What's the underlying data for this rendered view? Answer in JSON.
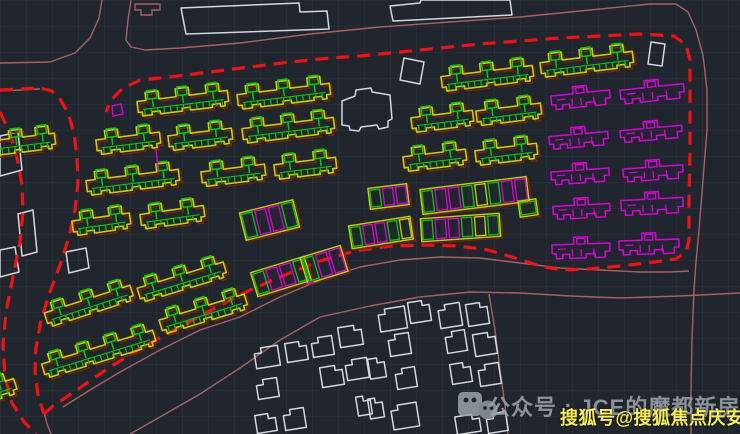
{
  "app": {
    "description": "CAD site plan viewport, dark theme",
    "canvas": {
      "width": 740,
      "height": 434,
      "background": "#20262e",
      "grid_size": 26
    }
  },
  "colors": {
    "yellow": "#c9cf00",
    "green": "#0ac70a",
    "magenta": "#d902d9",
    "red_dash": "#f51111",
    "red_underlay": "#7f1f06",
    "rose": "#a86063",
    "white_outline": "#d4d8dc",
    "watermark_gray": "#9aa2aa",
    "watermark_yellow": "#f6ee52"
  },
  "watermark": {
    "icon": "wechat-icon",
    "gray_text": "公众号 : JCE的魔都新房",
    "yellow_text": "搜狐号@搜狐焦点庆安站"
  },
  "site_plan": {
    "boundary_dash": [
      [
        44,
        414
      ],
      [
        53,
        406
      ],
      [
        77,
        390
      ],
      [
        110,
        367
      ],
      [
        143,
        347
      ],
      [
        180,
        327
      ],
      [
        215,
        308
      ],
      [
        250,
        290
      ],
      [
        285,
        275
      ],
      [
        320,
        261
      ],
      [
        355,
        251
      ],
      [
        390,
        246
      ],
      [
        425,
        245
      ],
      [
        458,
        246
      ],
      [
        488,
        250
      ],
      [
        515,
        258
      ],
      [
        540,
        266
      ],
      [
        562,
        270
      ],
      [
        588,
        269
      ],
      [
        620,
        266
      ],
      [
        655,
        262
      ],
      [
        676,
        259
      ],
      [
        686,
        252
      ],
      [
        689,
        240
      ],
      [
        689,
        200
      ],
      [
        690,
        150
      ],
      [
        690,
        100
      ],
      [
        690,
        60
      ],
      [
        686,
        45
      ],
      [
        674,
        36
      ],
      [
        640,
        34
      ],
      [
        600,
        36
      ],
      [
        560,
        38
      ],
      [
        520,
        41
      ],
      [
        480,
        44
      ],
      [
        440,
        48
      ],
      [
        400,
        52
      ],
      [
        360,
        56
      ],
      [
        330,
        58
      ],
      [
        290,
        62
      ],
      [
        250,
        67
      ],
      [
        210,
        72
      ],
      [
        170,
        77
      ],
      [
        140,
        80
      ],
      [
        122,
        89
      ],
      [
        111,
        100
      ],
      [
        106,
        112
      ]
    ],
    "road_dash_right": [
      [
        0,
        90
      ],
      [
        40,
        88
      ],
      [
        52,
        91
      ],
      [
        60,
        99
      ],
      [
        68,
        113
      ],
      [
        74,
        133
      ],
      [
        77,
        158
      ],
      [
        78,
        183
      ],
      [
        75,
        210
      ],
      [
        69,
        237
      ],
      [
        60,
        265
      ],
      [
        50,
        292
      ],
      [
        41,
        320
      ],
      [
        36,
        348
      ],
      [
        35,
        372
      ],
      [
        38,
        395
      ],
      [
        44,
        414
      ]
    ],
    "road_dash_left": [
      [
        0,
        112
      ],
      [
        10,
        133
      ],
      [
        17,
        158
      ],
      [
        22,
        185
      ],
      [
        23,
        212
      ],
      [
        20,
        242
      ],
      [
        13,
        277
      ],
      [
        6,
        312
      ],
      [
        3,
        345
      ],
      [
        5,
        377
      ],
      [
        12,
        403
      ],
      [
        24,
        422
      ],
      [
        36,
        434
      ]
    ],
    "rose_paths": [
      [
        [
          0,
          63
        ],
        [
          50,
          62
        ],
        [
          75,
          53
        ],
        [
          90,
          38
        ],
        [
          99,
          18
        ],
        [
          102,
          0
        ]
      ],
      [
        [
          131,
          0
        ],
        [
          128,
          20
        ],
        [
          126,
          40
        ],
        [
          131,
          47
        ],
        [
          145,
          50
        ],
        [
          180,
          48
        ],
        [
          240,
          43
        ],
        [
          310,
          34
        ],
        [
          380,
          27
        ],
        [
          450,
          22
        ],
        [
          520,
          17
        ],
        [
          590,
          10
        ],
        [
          650,
          4
        ],
        [
          676,
          4
        ],
        [
          688,
          12
        ],
        [
          696,
          30
        ],
        [
          703,
          55
        ],
        [
          707,
          90
        ],
        [
          707,
          130
        ],
        [
          703,
          180
        ],
        [
          699,
          230
        ],
        [
          696,
          262
        ],
        [
          694,
          290
        ],
        [
          692,
          340
        ],
        [
          691,
          390
        ],
        [
          691,
          434
        ]
      ],
      [
        [
          63,
          407
        ],
        [
          90,
          390
        ],
        [
          120,
          372
        ],
        [
          160,
          350
        ],
        [
          200,
          330
        ],
        [
          240,
          317
        ],
        [
          280,
          297
        ],
        [
          320,
          280
        ],
        [
          360,
          267
        ],
        [
          400,
          260
        ],
        [
          440,
          257
        ],
        [
          480,
          258
        ],
        [
          520,
          263
        ],
        [
          560,
          268
        ],
        [
          600,
          270
        ],
        [
          640,
          272
        ],
        [
          670,
          272
        ],
        [
          689,
          271
        ]
      ],
      [
        [
          130,
          434
        ],
        [
          160,
          417
        ],
        [
          200,
          394
        ],
        [
          240,
          368
        ],
        [
          280,
          340
        ],
        [
          320,
          317
        ],
        [
          370,
          306
        ],
        [
          420,
          297
        ],
        [
          470,
          292
        ],
        [
          520,
          293
        ],
        [
          570,
          296
        ],
        [
          620,
          298
        ],
        [
          680,
          296
        ],
        [
          740,
          293
        ]
      ],
      [
        [
          489,
          294
        ],
        [
          495,
          330
        ],
        [
          500,
          370
        ],
        [
          505,
          405
        ],
        [
          508,
          434
        ]
      ],
      [
        [
          44,
          412
        ],
        [
          47,
          424
        ],
        [
          51,
          434
        ]
      ],
      [
        [
          0,
          91
        ],
        [
          40,
          89
        ]
      ]
    ],
    "rose_tab": [
      [
        135,
        4
      ],
      [
        160,
        4
      ],
      [
        160,
        10
      ],
      [
        152,
        10
      ],
      [
        152,
        15
      ],
      [
        141,
        15
      ],
      [
        141,
        10
      ],
      [
        135,
        10
      ]
    ],
    "yellow_buildings": [
      [
        137,
        86,
        91,
        3,
        -7
      ],
      [
        237,
        79,
        93,
        3,
        -7
      ],
      [
        441,
        61,
        92,
        3,
        -7
      ],
      [
        540,
        47,
        93,
        3,
        -7
      ],
      [
        -25,
        128,
        80,
        3,
        -7
      ],
      [
        96,
        126,
        64,
        2,
        -7
      ],
      [
        168,
        122,
        64,
        2,
        -7
      ],
      [
        242,
        113,
        92,
        3,
        -7
      ],
      [
        411,
        104,
        62,
        2,
        -7
      ],
      [
        476,
        97,
        65,
        2,
        -7
      ],
      [
        86,
        165,
        93,
        3,
        -7
      ],
      [
        201,
        158,
        64,
        2,
        -7
      ],
      [
        274,
        151,
        62,
        2,
        -7
      ],
      [
        403,
        143,
        63,
        2,
        -7
      ],
      [
        475,
        137,
        62,
        2,
        -7
      ],
      [
        72,
        207,
        58,
        2,
        -8
      ],
      [
        140,
        200,
        64,
        2,
        -8
      ],
      [
        136,
        265,
        90,
        3,
        -17
      ],
      [
        43,
        289,
        90,
        3,
        -18
      ],
      [
        158,
        297,
        89,
        3,
        -17
      ],
      [
        40,
        337,
        116,
        4,
        -17
      ],
      [
        -46,
        378,
        62,
        2,
        -18
      ]
    ],
    "magenta_buildings": [
      [
        551,
        86,
        59,
        21,
        -6
      ],
      [
        620,
        80,
        64,
        21,
        -6
      ],
      [
        549,
        127,
        59,
        20,
        -5
      ],
      [
        620,
        121,
        62,
        19,
        -5
      ],
      [
        551,
        163,
        58,
        20,
        -4
      ],
      [
        623,
        160,
        60,
        20,
        -4
      ],
      [
        553,
        198,
        57,
        20,
        -3
      ],
      [
        621,
        192,
        62,
        22,
        -3
      ],
      [
        552,
        237,
        58,
        21,
        -2
      ],
      [
        619,
        233,
        60,
        21,
        -2
      ]
    ],
    "mixed_rows": [
      [
        242,
        206,
        55,
        28,
        4,
        -14
      ],
      [
        253,
        264,
        56,
        25,
        4,
        -17
      ],
      [
        303,
        251,
        42,
        27,
        3,
        -17
      ],
      [
        350,
        221,
        62,
        23,
        5,
        -9
      ],
      [
        421,
        216,
        79,
        23,
        6,
        -4
      ],
      [
        421,
        183,
        107,
        25,
        8,
        -7
      ],
      [
        369,
        186,
        39,
        21,
        3,
        -7
      ],
      [
        519,
        200,
        18,
        16,
        1,
        -8
      ]
    ],
    "houses": [
      [
        255,
        347,
        24,
        20
      ],
      [
        286,
        342,
        21,
        19
      ],
      [
        312,
        337,
        21,
        19
      ],
      [
        339,
        326,
        23,
        20
      ],
      [
        257,
        379,
        21,
        19
      ],
      [
        321,
        366,
        22,
        20
      ],
      [
        346,
        359,
        22,
        20
      ],
      [
        256,
        414,
        20,
        18
      ],
      [
        284,
        409,
        21,
        20
      ],
      [
        357,
        396,
        14,
        19
      ],
      [
        379,
        308,
        27,
        22
      ],
      [
        409,
        301,
        21,
        21
      ],
      [
        439,
        304,
        22,
        23
      ],
      [
        467,
        303,
        21,
        22
      ],
      [
        446,
        331,
        20,
        21
      ],
      [
        474,
        333,
        22,
        22
      ],
      [
        389,
        334,
        21,
        21
      ],
      [
        369,
        358,
        16,
        20
      ],
      [
        396,
        368,
        20,
        20
      ],
      [
        451,
        363,
        20,
        20
      ],
      [
        479,
        364,
        21,
        21
      ],
      [
        369,
        398,
        14,
        20
      ],
      [
        392,
        404,
        26,
        24
      ],
      [
        456,
        415,
        24,
        18
      ],
      [
        487,
        413,
        20,
        19
      ]
    ],
    "white_polygons": [
      [
        [
          181,
          8
        ],
        [
          299,
          3
        ],
        [
          300,
          12
        ],
        [
          327,
          11
        ],
        [
          329,
          29
        ],
        [
          186,
          34
        ]
      ],
      [
        [
          390,
          6
        ],
        [
          420,
          3
        ],
        [
          421,
          0
        ],
        [
          510,
          0
        ],
        [
          512,
          15
        ],
        [
          393,
          21
        ]
      ],
      [
        [
          651,
          42
        ],
        [
          665,
          44
        ],
        [
          662,
          66
        ],
        [
          648,
          64
        ]
      ],
      [
        [
          404,
          58
        ],
        [
          424,
          62
        ],
        [
          420,
          84
        ],
        [
          400,
          80
        ]
      ],
      [
        [
          342,
          101
        ],
        [
          355,
          96
        ],
        [
          356,
          90
        ],
        [
          371,
          88
        ],
        [
          372,
          92
        ],
        [
          390,
          95
        ],
        [
          392,
          119
        ],
        [
          388,
          121
        ],
        [
          388,
          127
        ],
        [
          379,
          129
        ],
        [
          377,
          125
        ],
        [
          361,
          127
        ],
        [
          359,
          131
        ],
        [
          350,
          130
        ],
        [
          349,
          126
        ],
        [
          342,
          125
        ]
      ],
      [
        [
          66,
          252
        ],
        [
          86,
          248
        ],
        [
          89,
          268
        ],
        [
          69,
          273
        ]
      ],
      [
        [
          0,
          136
        ],
        [
          18,
          132
        ],
        [
          22,
          170
        ],
        [
          0,
          176
        ]
      ],
      [
        [
          0,
          250
        ],
        [
          15,
          247
        ],
        [
          19,
          272
        ],
        [
          0,
          277
        ]
      ],
      [
        [
          18,
          214
        ],
        [
          33,
          210
        ],
        [
          37,
          252
        ],
        [
          22,
          256
        ]
      ]
    ],
    "extras": {
      "magenta_quad": [
        [
          112,
          106
        ],
        [
          121,
          104
        ],
        [
          123,
          114
        ],
        [
          113,
          116
        ]
      ],
      "magenta_line": [
        [
          156,
          149
        ],
        [
          158,
          170
        ]
      ],
      "magenta_tick": [
        [
          306,
          284
        ],
        [
          314,
          282
        ]
      ]
    }
  }
}
